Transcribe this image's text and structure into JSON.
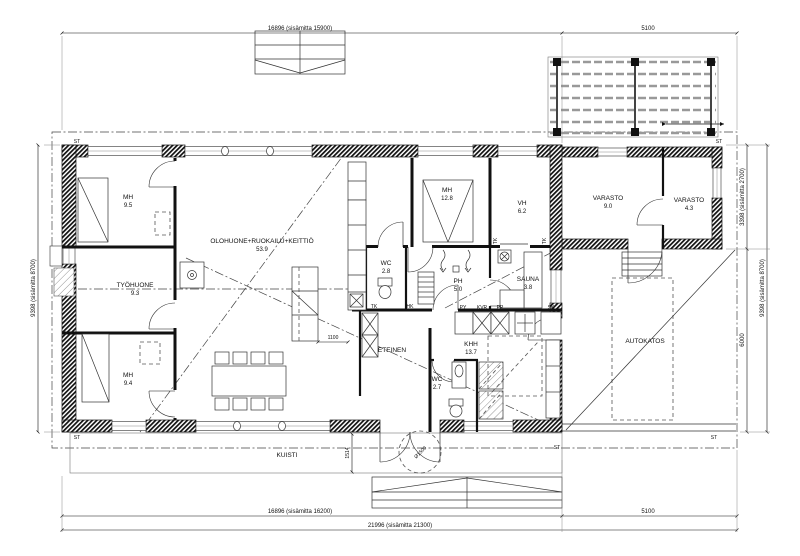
{
  "drawing": {
    "type": "architectural floor plan"
  },
  "rooms": [
    {
      "name": "MH",
      "area": "9.5"
    },
    {
      "name": "TYÖHUONE",
      "area": "9.3"
    },
    {
      "name": "MH",
      "area": "9.4"
    },
    {
      "name": "OLOHUONE+RUOKAILU+KEITTIÖ",
      "area": "53.9"
    },
    {
      "name": "MH",
      "area": "12.8"
    },
    {
      "name": "VH",
      "area": "6.2"
    },
    {
      "name": "WC",
      "area": "2.8"
    },
    {
      "name": "PH",
      "area": "5.0"
    },
    {
      "name": "SAUNA",
      "area": "3.8"
    },
    {
      "name": "ETEINEN"
    },
    {
      "name": "KHH",
      "area": "13.7"
    },
    {
      "name": "WC",
      "area": "2.7"
    },
    {
      "name": "VARASTO",
      "area": "9.0"
    },
    {
      "name": "VARASTO",
      "area": "4.3"
    },
    {
      "name": "AUTOKATOS"
    },
    {
      "name": "KUISTI"
    }
  ],
  "dims": {
    "top_main": "16896 (sisämitta 15900)",
    "top_right": "5100",
    "bottom_main": "16896 (sisämitta 16200)",
    "bottom_right": "5100",
    "bottom_total": "21996 (sisämitta 21300)",
    "left": "9398 (sisämitta 8700)",
    "right_upper": "3398 (sisämitta 2700)",
    "right_lower": "6000",
    "right_total": "9398 (sisämitta 8700)",
    "porch_depth": "1514",
    "island_clearance": "1100",
    "turning_circle": "Ø1500"
  },
  "markers": {
    "st": "ST",
    "tk": "TK",
    "hk": "HK",
    "py": "PY",
    "kvr": "KVR",
    "pp": "PP",
    "sk": "SK"
  }
}
